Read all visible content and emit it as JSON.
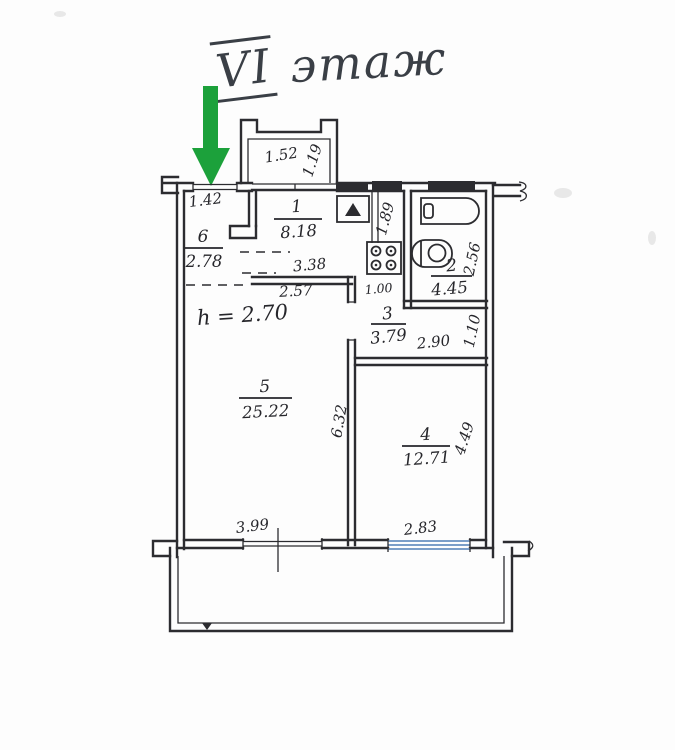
{
  "floor_title": {
    "roman": "VI",
    "word": "этаж"
  },
  "plan": {
    "ceiling_height_note": "h = 2.70",
    "rooms": [
      {
        "number": "1",
        "area": "8.18"
      },
      {
        "number": "2",
        "area": "4.45"
      },
      {
        "number": "3",
        "area": "3.79"
      },
      {
        "number": "4",
        "area": "12.71"
      },
      {
        "number": "5",
        "area": "25.22"
      },
      {
        "number": "6",
        "area": "2.78"
      }
    ],
    "dims": {
      "balcony_width": "1.52",
      "balcony_depth": "1.19",
      "entry_width": "1.42",
      "kitchen_width": "3.38",
      "corridor_width": "2.57",
      "niche_depth": "1.89",
      "bathroom_depth": "2.56",
      "door_width": "1.00",
      "hall_width": "2.90",
      "hall_depth": "1.10",
      "living_depth": "6.32",
      "living_width": "3.99",
      "bedroom_depth": "4.49",
      "bedroom_width": "2.83"
    },
    "colors": {
      "arrow_green": "#1ca13b",
      "ink": "#2c2c30",
      "window_blue": "#7b9ec8"
    }
  }
}
